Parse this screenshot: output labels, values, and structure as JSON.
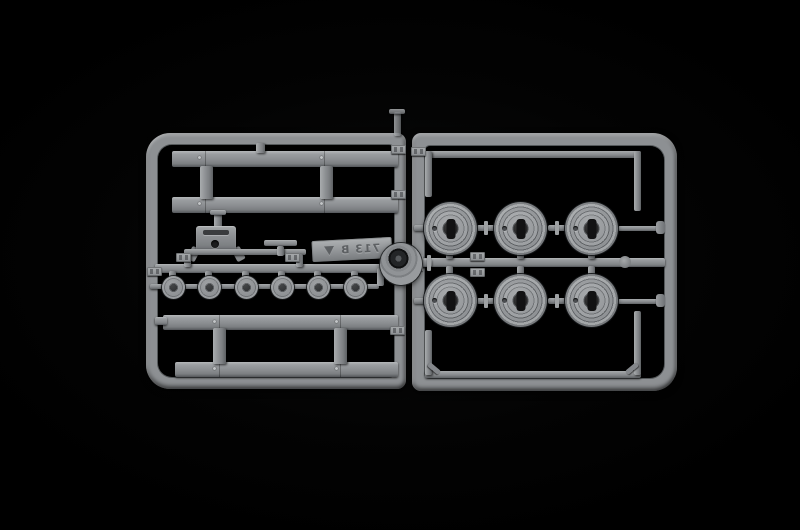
{
  "scene": {
    "description": "Photograph of a light-gray injection-molded plastic model kit sprue on a black background",
    "background_color": "#000000",
    "plastic_color": "#8d9093"
  },
  "sprue": {
    "marking": "713 B",
    "marking_mirrored": true,
    "logo": "molder-triangle-logo"
  },
  "parts": {
    "road_wheels": 6,
    "hub_caps": 6,
    "side_rails": 4,
    "gearbox_bracket": 1,
    "t_bracket": 1
  }
}
